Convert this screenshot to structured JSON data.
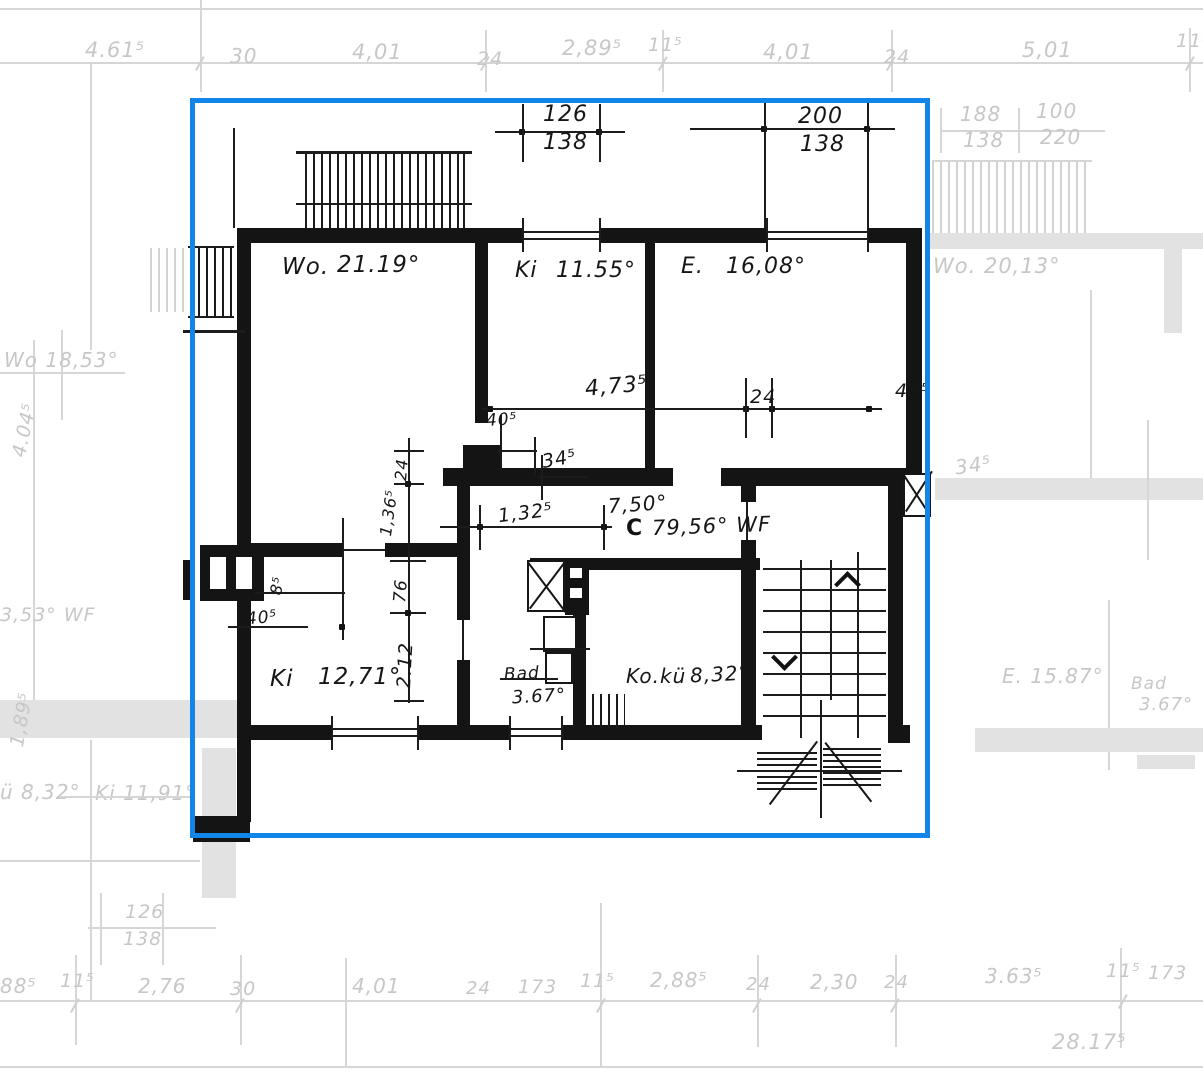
{
  "meta": {
    "highlight_color": "#1285e8"
  },
  "plan": {
    "window_dim_1": {
      "width": "126",
      "height": "138"
    },
    "window_dim_2": {
      "width": "200",
      "height": "138"
    },
    "rooms": {
      "living": {
        "name": "Wo.",
        "area": "21.19°"
      },
      "child1": {
        "name": "Ki",
        "area": "11.55°"
      },
      "entry": {
        "name": "E.",
        "area": "16,08°"
      },
      "child2": {
        "name": "Ki",
        "area": "12,71°"
      },
      "bath": {
        "name": "Bad",
        "area": "3.67°"
      },
      "kitchen": {
        "name": "Ko.kü",
        "area": "8,32°"
      },
      "total": {
        "name": "C",
        "area": "79,56° WF"
      }
    },
    "dims": {
      "hall_width": "7,50°",
      "d_473": "4,73⁵",
      "d_24_top": "24",
      "d_46": "46⁵",
      "d_40_a": "40⁵",
      "d_34": "34⁵",
      "d_24_v": "24",
      "d_136": "1,36⁵",
      "d_132": "1,32⁵",
      "d_76": "76",
      "d_212": "2.12",
      "d_8": "8⁵",
      "d_40_b": "40⁵"
    }
  },
  "surroundings": {
    "top_ruler": [
      "4.61⁵",
      "30",
      "4,01",
      "24",
      "2,89⁵",
      "11⁵",
      "4,01",
      "24",
      "5,01",
      "11⁵"
    ],
    "bottom_ruler": [
      "88⁵",
      "11⁵",
      "2,76",
      "30",
      "4,01",
      "24",
      "173",
      "11⁵",
      "2,88⁵",
      "24",
      "2,30",
      "24",
      "3.63⁵",
      "11⁵",
      "173"
    ],
    "overall_width": "28.17⁵",
    "right_window": {
      "w1": "188",
      "w2": "100",
      "h1": "138",
      "h2": "220"
    },
    "right_rooms": {
      "living": "Wo.  20,13°",
      "entry": "E.   15.87°",
      "bath_name": "Bad",
      "bath_area": "3.67°"
    },
    "left_rooms": {
      "living": "Wo   18,53°",
      "wf": "3,53° WF",
      "kitchen": "ü  8,32°",
      "child": "Ki  11,91°"
    },
    "left_dims": {
      "v404": "4.04⁵",
      "v189": "1,89⁵"
    },
    "bottom_window": {
      "width": "126",
      "height": "138"
    }
  }
}
